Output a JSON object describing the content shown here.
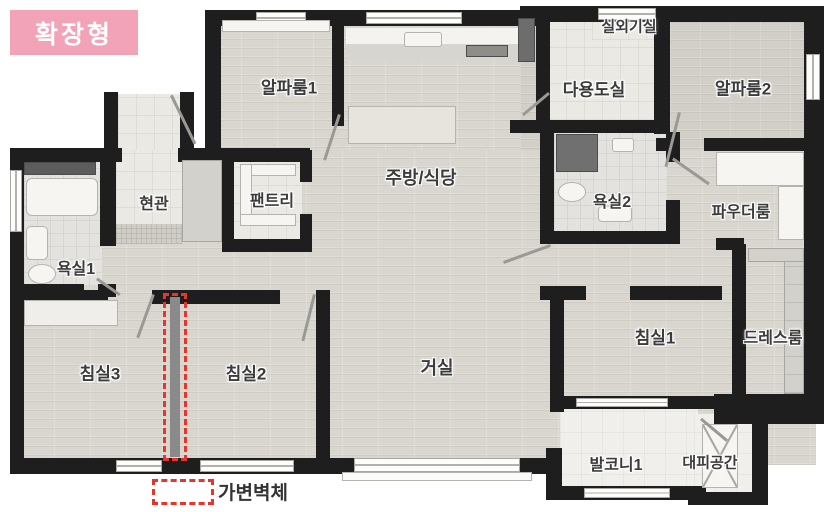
{
  "badge": {
    "label": "확장형"
  },
  "rooms": {
    "alpharoom1": {
      "label": "알파룸1"
    },
    "kitchen_dining": {
      "label": "주방/식당"
    },
    "outdoor_unit": {
      "label": "실외기실"
    },
    "utility": {
      "label": "다용도실"
    },
    "alpharoom2": {
      "label": "알파룸2"
    },
    "entrance": {
      "label": "현관"
    },
    "pantry": {
      "label": "팬트리"
    },
    "bathroom1": {
      "label": "욕실1"
    },
    "bathroom2": {
      "label": "욕실2"
    },
    "powder_room": {
      "label": "파우더룸"
    },
    "bedroom3": {
      "label": "침실3"
    },
    "bedroom2": {
      "label": "침실2"
    },
    "living_room": {
      "label": "거실"
    },
    "bedroom1": {
      "label": "침실1"
    },
    "dress_room": {
      "label": "드레스룸"
    },
    "balcony1": {
      "label": "발코니1"
    },
    "shelter": {
      "label": "대피공간"
    }
  },
  "legend": {
    "movable_wall_label": "가변벽체"
  },
  "colors": {
    "badge_pink": "#f2a3b7",
    "wall_black": "#1e1e1e",
    "movable_wall_red": "#e7352c",
    "wood_floor": "#d9d6cf",
    "tile_floor": "#ebe9e4"
  }
}
